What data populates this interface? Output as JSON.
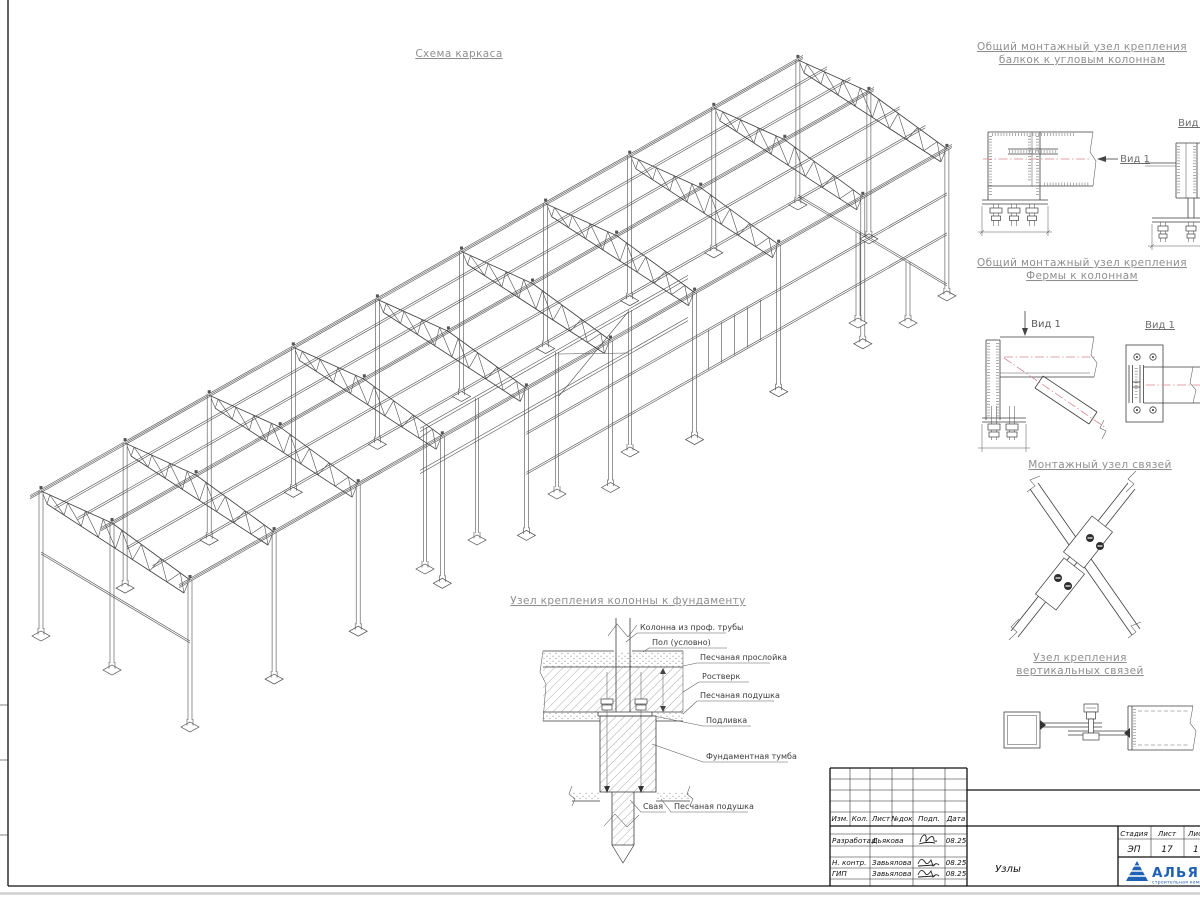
{
  "titles": {
    "main": "Схема каркаса",
    "corner_l1": "Общий монтажный узел крепления",
    "corner_l2": "балкок к угловым колоннам",
    "truss_l1": "Общий монтажный узел крепления",
    "truss_l2": "Фермы к колоннам",
    "brace": "Монтажный узел связей",
    "vert_l1": "Узел крепления",
    "vert_l2": "вертикальных связей",
    "foundation": "Узел крепления колонны к фундаменту"
  },
  "view_labels": {
    "vid1": "Вид 1"
  },
  "foundation_callouts": {
    "column": "Колонна из проф. трубы",
    "floor": "Пол (условно)",
    "sand_layer": "Песчаная прослойка",
    "grillage": "Ростверк",
    "sand_cushion": "Песчаная подушка",
    "grout": "Подливка",
    "pedestal": "Фундаментная тумба",
    "pile": "Свая",
    "sand_cushion2": "Песчаная подушка"
  },
  "title_block": {
    "headers": {
      "izm": "Изм.",
      "kol": "Кол.",
      "list": "Лист",
      "ndok": "№док",
      "podp": "Подп.",
      "data": "Дата"
    },
    "rows": {
      "r1_role": "Разработал",
      "r1_name": "Дьякова",
      "r1_date": "08.25",
      "r2_role": "Н. контр.",
      "r2_name": "Завьялова",
      "r2_date": "08.25",
      "r3_role": "ГИП",
      "r3_name": "Завьялова",
      "r3_date": "08.25"
    },
    "doc_title": "Узлы",
    "stage_header": "Стадия",
    "sheet_header": "Лист",
    "sheets_header": "Листов",
    "stage": "ЭП",
    "sheet_no": "17",
    "sheets_total": "1",
    "company": "АЛЬЯНС",
    "company_sub": "строительная компания"
  },
  "colors": {
    "brand_blue": "#1f62b5",
    "centerline_red": "#d9868f"
  }
}
